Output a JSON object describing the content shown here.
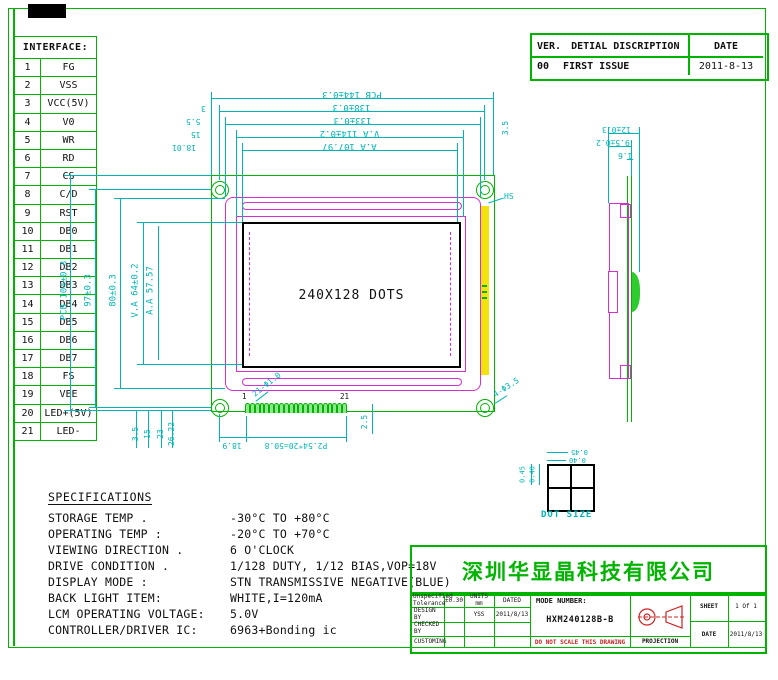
{
  "colors": {
    "green": "#00b400",
    "cyan": "#00b5b5",
    "magenta": "#d32fd3",
    "yellow": "#f2e40a",
    "red": "#cc2222",
    "ink": "#111111"
  },
  "revision_table": {
    "ver": "VER.",
    "desc": "DETIAL DISCRIPTION",
    "date": "DATE",
    "row": {
      "ver": "00",
      "desc": "FIRST ISSUE",
      "date": "2011-8-13"
    }
  },
  "interface_table": {
    "title": "INTERFACE:",
    "pins": [
      [
        "1",
        "FG"
      ],
      [
        "2",
        "VSS"
      ],
      [
        "3",
        "VCC(5V)"
      ],
      [
        "4",
        "V0"
      ],
      [
        "5",
        "WR"
      ],
      [
        "6",
        "RD"
      ],
      [
        "7",
        "CS"
      ],
      [
        "8",
        "C/D"
      ],
      [
        "9",
        "RST"
      ],
      [
        "10",
        "DB0"
      ],
      [
        "11",
        "DB1"
      ],
      [
        "12",
        "DB2"
      ],
      [
        "13",
        "DB3"
      ],
      [
        "14",
        "DB4"
      ],
      [
        "15",
        "DB5"
      ],
      [
        "16",
        "DB6"
      ],
      [
        "17",
        "DB7"
      ],
      [
        "18",
        "FS"
      ],
      [
        "19",
        "VEE"
      ],
      [
        "20",
        "LED+(5V)"
      ],
      [
        "21",
        "LED-"
      ]
    ]
  },
  "front_view": {
    "display_text": "240X128 DOTS",
    "pin_first_label": "1",
    "pin_last_label": "21",
    "strip_label": "HS"
  },
  "dims": {
    "top": [
      "PCB 144±0.3",
      "138±0.3",
      "133±0.3",
      "V.A 114±0.2",
      "A.A 107.97"
    ],
    "top_small": [
      "3",
      "5.5",
      "15",
      "18.01",
      "3.5"
    ],
    "left": [
      "PCB 104±0.3",
      "97±0.3",
      "80±0.3",
      "V.A 64±0.2",
      "A.A 57.57"
    ],
    "bottom_small": [
      "3.5",
      "15",
      "23",
      "26.22"
    ],
    "bottom": [
      "18.9",
      "P2.54*20=50.8",
      "2.5"
    ],
    "callout_pin": "21-Φ1.0",
    "callout_hole": "4-Φ3.5",
    "side": [
      "12±0.3",
      "9.5±0.2",
      "1.6"
    ],
    "dot_h": [
      "0.45",
      "0.40"
    ],
    "dot_v": [
      "0.45",
      "0.40"
    ],
    "dot_label": "DOT SIZE"
  },
  "specifications": {
    "title": "SPECIFICATIONS",
    "items": [
      {
        "label": "STORAGE TEMP .",
        "value": "-30°C TO +80°C"
      },
      {
        "label": "OPERATING TEMP :",
        "value": "-20°C TO +70°C"
      },
      {
        "label": "VIEWING DIRECTION .",
        "value": "6 O'CLOCK"
      },
      {
        "label": "DRIVE CONDITION .",
        "value": "1/128 DUTY, 1/12 BIAS,VOP=18V"
      },
      {
        "label": "DISPLAY MODE :",
        "value": "STN TRANSMISSIVE NEGATIVE(BLUE)"
      },
      {
        "label": "BACK LIGHT ITEM:",
        "value": "WHITE,I=120mA"
      },
      {
        "label": "LCM OPERATING VOLTAGE:",
        "value": "5.0V"
      },
      {
        "label": "CONTROLLER/DRIVER IC:",
        "value": "6963+Bonding ic"
      }
    ]
  },
  "company": {
    "name": "深圳华显晶科技有限公司"
  },
  "title_block": {
    "tolerance_label": "Unspecified Tolerance",
    "tolerance_value": "±0.30",
    "units": "UNITS mm",
    "dated": "DATED",
    "design_label": "DESIGN BY",
    "design_value": "YSS",
    "design_date": "2011/8/13",
    "checked_label": "CHECKED BY",
    "customer_label": "CUSTOMING",
    "model_label": "MODE NUMBER:",
    "model_value": "HXM240128B-B",
    "no_scale": "DO NOT SCALE THIS DRAWING",
    "projection_label": "PROJECTION",
    "sheet_label": "SHEET",
    "sheet_value": "1 Of 1",
    "date_label": "DATE",
    "date_value": "2011/8/13"
  }
}
